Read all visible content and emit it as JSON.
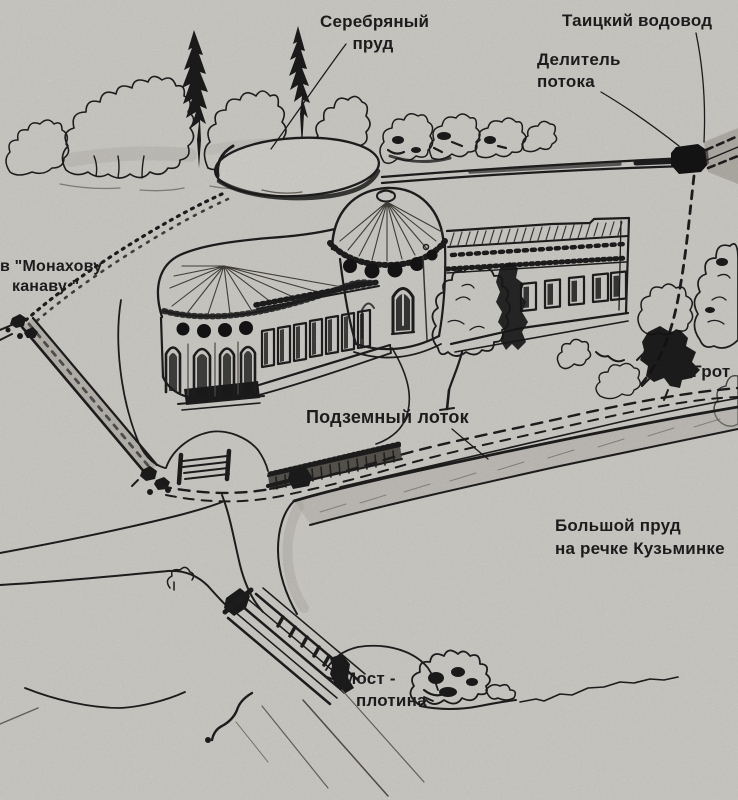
{
  "colors": {
    "paper": "#d7d5d0",
    "ink": "#1c1c1c",
    "pencil_light": "#6b675f"
  },
  "labels": {
    "silver_pond": {
      "line1": "Серебряный",
      "line2": "пруд"
    },
    "taitsky_aqueduct": {
      "text": "Таицкий водовод"
    },
    "flow_divider": {
      "line1": "Делитель",
      "line2": "потока"
    },
    "monks_ditch": {
      "line1": "в \"Монахову",
      "line2": "канаву \""
    },
    "grotto": {
      "text": "Грот"
    },
    "underground_conduit": {
      "text": "Подземный лоток"
    },
    "big_pond": {
      "line1": "Большой пруд",
      "line2": "на речке Кузьминке"
    },
    "bridge_dam": {
      "line1": "Мост -",
      "line2": "плотина"
    }
  }
}
